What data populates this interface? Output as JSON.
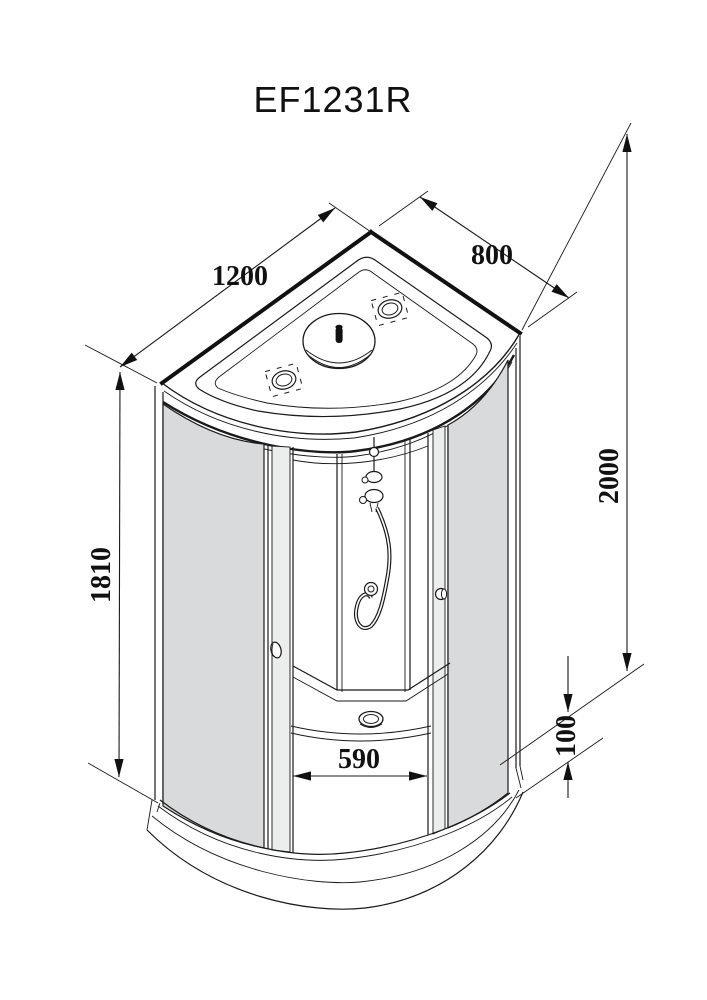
{
  "title": "EF1231R",
  "dimensions": {
    "width_mm": "1200",
    "depth_mm": "800",
    "height_mm": "2000",
    "glass_height_mm": "1810",
    "entry_width_mm": "590",
    "tray_height_mm": "100"
  },
  "colors": {
    "line": "#1a1a1a",
    "glass_tint": "#d8dadb",
    "background": "#ffffff"
  }
}
